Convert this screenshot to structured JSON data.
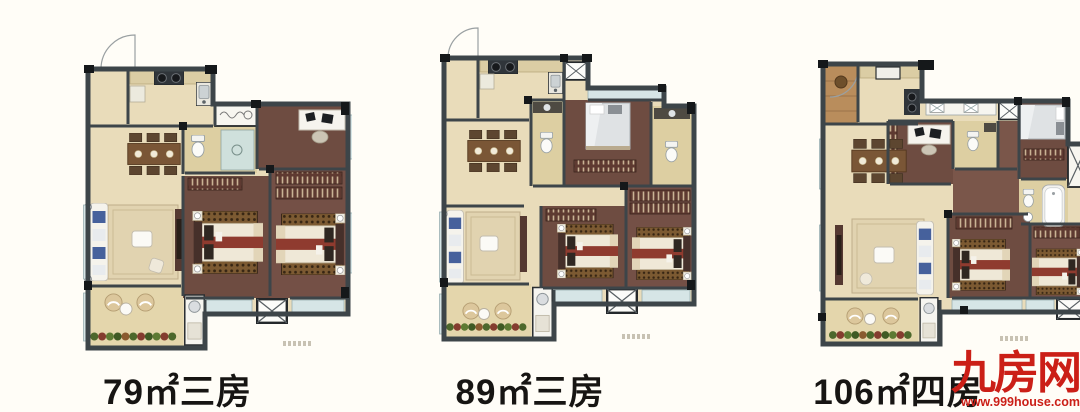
{
  "plans": [
    {
      "label": "79㎡三房",
      "area": "79㎡",
      "rooms": "三房"
    },
    {
      "label": "89㎡三房",
      "area": "89㎡",
      "rooms": "三房"
    },
    {
      "label": "106㎡四房",
      "area": "106㎡",
      "rooms": "四房"
    }
  ],
  "watermark": {
    "logo": "九房网",
    "url": "www.999house.com"
  },
  "palette": {
    "bg": "#fffdf7",
    "ink": "#171513",
    "brand_red": "#cb1f17",
    "wall": "#3d4549",
    "wall_black": "#15181a",
    "floor_light": "#e9dcba",
    "floor_bath": "#ddcfa2",
    "floor_bedroom": "#6e4c41",
    "floor_bedroom_alt": "#745046",
    "balcony": "#e4d6ac",
    "window_glass": "#d6e5e6",
    "plant_green": "#4d682c",
    "plant_red": "#843c2f",
    "sofa_blue": "#46619c"
  }
}
